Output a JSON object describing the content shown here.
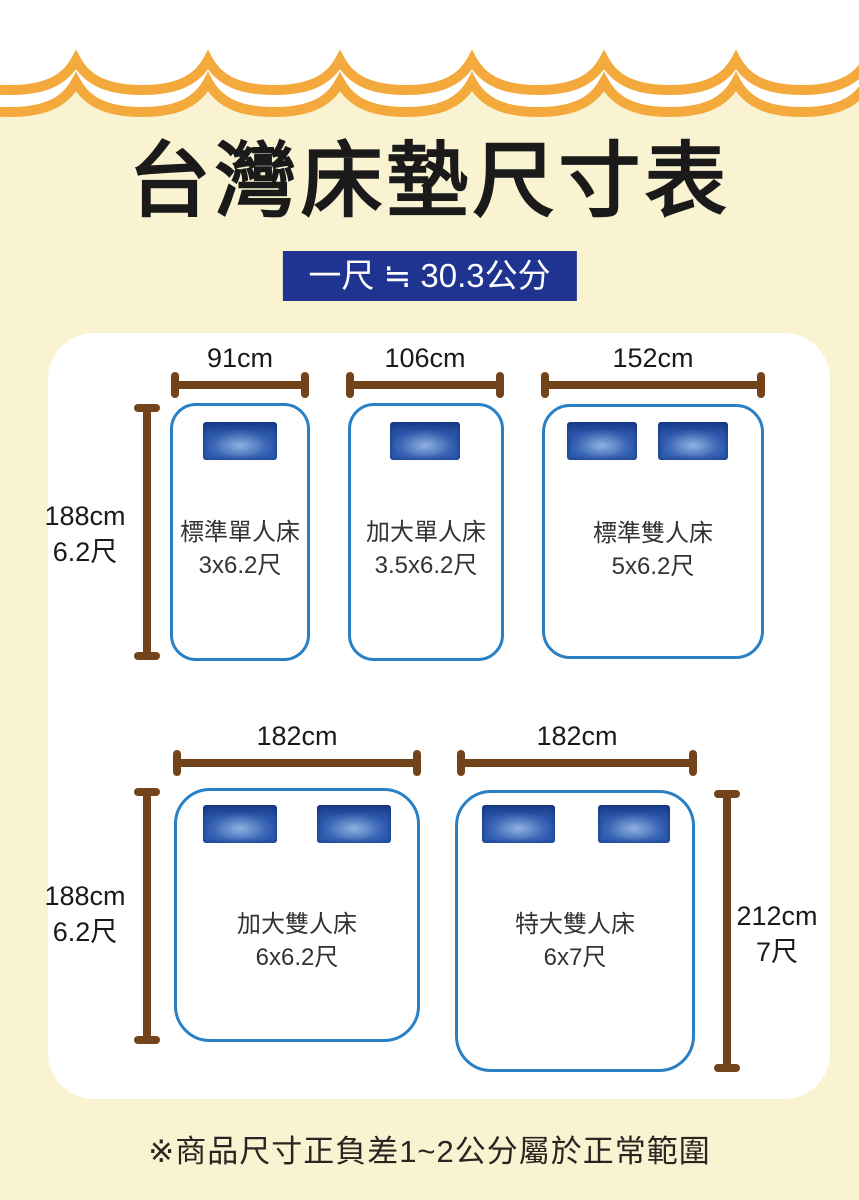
{
  "title": "台灣床墊尺寸表",
  "badge": "一尺 ≒ 30.3公分",
  "footnote": "※商品尺寸正負差1~2公分屬於正常範圍",
  "colors": {
    "background": "#FAF3D2",
    "wave": "#F3A93C",
    "badge_bg": "#1F3490",
    "bed_border": "#2A80C4",
    "ruler": "#73431B",
    "ink": "#1A1A1A",
    "label_ink": "#333333"
  },
  "beds": [
    {
      "name": "標準單人床",
      "size": "3x6.2尺",
      "width": "91cm",
      "pillows": 1
    },
    {
      "name": "加大單人床",
      "size": "3.5x6.2尺",
      "width": "106cm",
      "pillows": 1
    },
    {
      "name": "標準雙人床",
      "size": "5x6.2尺",
      "width": "152cm",
      "pillows": 2
    },
    {
      "name": "加大雙人床",
      "size": "6x6.2尺",
      "width": "182cm",
      "pillows": 2
    },
    {
      "name": "特大雙人床",
      "size": "6x7尺",
      "width": "182cm",
      "pillows": 2
    }
  ],
  "height_labels": {
    "row1_left": {
      "cm": "188cm",
      "tw": "6.2尺"
    },
    "row2_left": {
      "cm": "188cm",
      "tw": "6.2尺"
    },
    "row2_right": {
      "cm": "212cm",
      "tw": "7尺"
    }
  }
}
